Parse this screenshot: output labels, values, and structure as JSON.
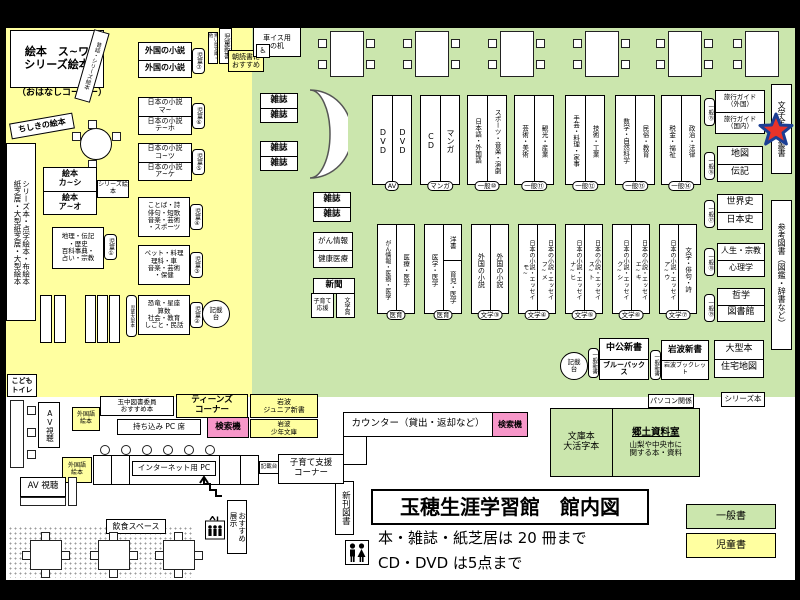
{
  "legend": {
    "general_label": "一般書",
    "children_label": "児童書"
  },
  "title_block": {
    "title": "玉穂生涯学習館　館内図",
    "rule1": "本・雑誌・紙芝居は 20 冊まで",
    "rule2": "CD・DVD は5点まで"
  },
  "colors": {
    "children_area": "#ffffa0",
    "general_area": "#cbe6ad",
    "search_machine": "#f797c9",
    "star_fill": "#e8332a",
    "star_stroke": "#1c3f94"
  },
  "c": {
    "ehon_main": "絵本　ス~ワ\nシリーズ絵本",
    "ohanashi": "（おはなしコーナー）",
    "mukashi": "昔話・シリーズ絵本",
    "chishiki": "ちしきの絵本",
    "series_box": "シリーズ本・点字絵本・布絵本\n紙芝居・大型紙芝居・大型絵本",
    "aoitori": "青い鳥文庫・他",
    "jido_shinsho": "児童新書",
    "asadoku": "朝読書に\nおすすめ",
    "foreign": {
      "r1": "外国の小説",
      "r2": "外国の小説",
      "badge": "児童⑦"
    },
    "jp_ma": {
      "r1": "日本の小説\nマ~",
      "r2": "日本の小説\nテ~ホ",
      "badge": "児童⑥"
    },
    "jp_ko": {
      "r1": "日本の小説\nコ~ツ",
      "r2": "日本の小説\nア~ケ",
      "badge": "児童⑤"
    },
    "ehon_ka": {
      "r1": "絵本\nカ~シ",
      "r2": "絵本\nア~オ",
      "side": "シリーズ絵本"
    },
    "kotoba": {
      "text": "ことば・詩\n俳句・短歌\n音楽・芸術\n・スポーツ",
      "badge": "児童④"
    },
    "chiri": {
      "text": "地理・伝記\n・歴史\n百科事典・\n占い・宗教",
      "badge": "児童①"
    },
    "pet": {
      "text": "ペット・料理\n理科・車\n音楽・芸術\n・保健",
      "badge": "児童③"
    },
    "kyoryu": {
      "text": "恐竜・星座\n算数\n社会・教育\nしごと・民話",
      "badge": "児童②"
    },
    "oogata_label": "児童大型本",
    "kisaidai": "記載\n台",
    "toilet": "こども\nトイレ"
  },
  "g": {
    "wheelchair_desk": "車イス用\nの机",
    "wheelchair_glyph": "♿",
    "zasshi": "雑誌",
    "gan_box": {
      "r1": "がん情報",
      "r2": "健康医療"
    },
    "shinbun": "新聞",
    "kosodate_ouen": "子育て\n応援",
    "bungakusho": "文学賞",
    "row1": [
      {
        "l": "DVD",
        "r": "DVD",
        "b": "AV"
      },
      {
        "l": "CD",
        "r": "マンガ",
        "b": "マンガ"
      },
      {
        "l": "日本語・外国語",
        "r": "スポーツ・音楽・演劇",
        "b": "一般⑩"
      },
      {
        "l": "芸術・美術",
        "r": "観光・産業",
        "b": "一般⑪"
      },
      {
        "l": "手芸・料理・家事",
        "r": "技術・工業",
        "b": "一般⑫"
      },
      {
        "l": "数学・自然科学",
        "r": "民俗・教育",
        "b": "一般⑬"
      },
      {
        "l": "税金・福祉",
        "r": "政治・法律",
        "b": "一般⑭"
      }
    ],
    "row2": [
      {
        "l": "がん情報・医療・医学",
        "r": "医療・医学",
        "b": "医育"
      },
      {
        "l": "医学・医学",
        "rt": "洋書",
        "rb": "育児・医学",
        "b": "医育"
      },
      {
        "l": "外国の小説",
        "r": "外国の小説",
        "b": "文学③"
      },
      {
        "l": "日本の小説・エッセイ\nモ~",
        "r": "日本の小説・エッセイ\nフ~メ",
        "b": "文学④"
      },
      {
        "l": "日本の小説・エッセイ\nナ~ヒ",
        "r": "日本の小説・エッセイ\nス~ト",
        "b": "文学⑤"
      },
      {
        "l": "日本の小説・エッセイ\nク~シ",
        "r": "日本の小説・エッセイ\nエ~キ",
        "b": "文学⑥"
      },
      {
        "l": "日本の小説・エッセイ\nア~ウ",
        "r": "文学・俳句・詩",
        "b": "文学⑦"
      }
    ],
    "pairs": [
      {
        "r1": "旅行ガイド\n（外国）",
        "r2": "旅行ガイド\n（国内）",
        "b": "一般⑮"
      },
      {
        "r1": "地図",
        "r2": "伝記",
        "b": "一般⑯"
      },
      {
        "r1": "世界史",
        "r2": "日本史",
        "b": "一般⑰"
      },
      {
        "r1": "人生・宗教",
        "r2": "心理学",
        "b": "一般⑱"
      },
      {
        "r1": "哲学",
        "r2": "図書館",
        "b": "一般⑲"
      },
      {
        "r1": "大型本",
        "r2": "住宅地図",
        "b": ""
      }
    ],
    "strip_bungaku": "文学全集・叢書",
    "strip_sanko": "参考図書（図鑑・辞書など）",
    "kisaidai": "記載\n台",
    "shinsho1": {
      "badge": "一般新書",
      "r1": "中公新書",
      "r2": "ブルーバックス"
    },
    "shinsho2": {
      "badge": "一般新書",
      "r1": "岩波新書",
      "r2": "岩波ブックレット"
    },
    "pasokon": "パソコン関係",
    "series": "シリーズ本"
  },
  "b": {
    "counter": "カウンター（貸出・返却など）",
    "kensaku1": "検索機",
    "bunko": "文庫本\n大活字本",
    "kyodo_title": "郷土資料室",
    "kyodo_desc": "山梨や中央市に\n関する本・資料",
    "shinkan": "新刊図書",
    "gaikokugo1": "外国語\n絵本",
    "tamachu": "玉中図書委員\nおすすめ本",
    "teens": "ティーンズ\nコーナー",
    "iwanami_jr": "岩波\nジュニア新書",
    "mochikomi": "持ち込み PC 席",
    "kensaku2": "検索機",
    "iwanami_shonen": "岩波\n少年文庫",
    "gaikokugo2": "外国語\n絵本",
    "internet_pc": "インターネット用 PC",
    "kisaidai3": "記載台",
    "kosodate_corner": "子育て支援\nコーナー",
    "av1": "AV視聴",
    "av2": "AV 視聴",
    "inshoku": "飲食スペース",
    "osusume": "おすすめ\n展示"
  }
}
